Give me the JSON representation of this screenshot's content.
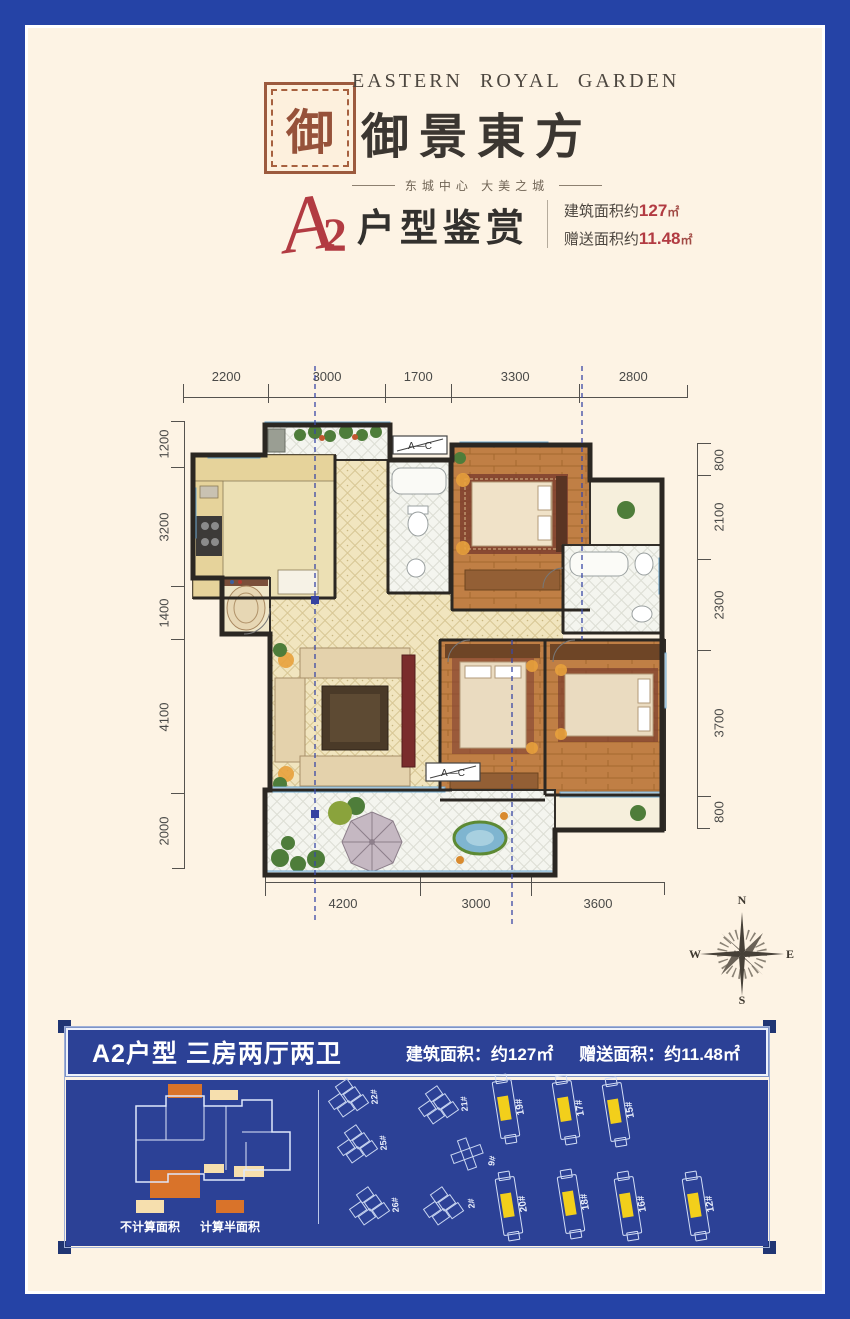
{
  "colors": {
    "frame_blue": "#2543a6",
    "background_cream": "#fdf3e4",
    "accent_red": "#b23b42",
    "panel_blue": "#2c4196",
    "highlight_yellow": "#f2cf1b",
    "seal_brown": "#9c5a3e"
  },
  "header": {
    "brand_en": "EASTERN ROYAL GARDEN",
    "brand_cn": "御景東方",
    "tagline": "东城中心  大美之城",
    "seal_glyph": "御"
  },
  "title": {
    "unit_letter": "A",
    "unit_number": "2",
    "suffix": "户型鉴赏",
    "area_label_1": "建筑面积约",
    "area_value_1": "127",
    "area_unit_1": "㎡",
    "area_label_2": "赠送面积约",
    "area_value_2": "11.48",
    "area_unit_2": "㎡"
  },
  "plan": {
    "dims_top": [
      2200,
      3000,
      1700,
      3300,
      2800
    ],
    "dims_left": [
      1200,
      3200,
      1400,
      4100,
      2000
    ],
    "dims_right": [
      800,
      2100,
      2300,
      3700,
      800
    ],
    "dims_bottom": [
      4200,
      3000,
      3600
    ],
    "ac_label": "A—C",
    "compass": {
      "north": "N",
      "south": "S",
      "east": "E",
      "west": "W"
    }
  },
  "bottom_panel": {
    "title": "A2户型 三房两厅两卫",
    "spec_1_label": "建筑面积：",
    "spec_1_value": "约127㎡",
    "spec_2_label": "赠送面积：",
    "spec_2_value": "约11.48㎡",
    "legend": [
      {
        "label": "不计算面积",
        "color": "#f6dfae"
      },
      {
        "label": "计算半面积",
        "color": "#d9732a"
      }
    ],
    "sitemap": {
      "buildings": [
        {
          "label": "22#",
          "type": "cluster",
          "x": 284,
          "y": 18,
          "rot": -35,
          "highlighted": false
        },
        {
          "label": "25#",
          "type": "cluster",
          "x": 293,
          "y": 64,
          "rot": -35,
          "highlighted": false
        },
        {
          "label": "26#",
          "type": "cluster",
          "x": 305,
          "y": 126,
          "rot": -35,
          "highlighted": false
        },
        {
          "label": "21#",
          "type": "cluster",
          "x": 374,
          "y": 25,
          "rot": -35,
          "highlighted": false
        },
        {
          "label": "9#",
          "type": "cross",
          "x": 401,
          "y": 74,
          "rot": -20,
          "highlighted": false
        },
        {
          "label": "2#",
          "type": "cluster",
          "x": 379,
          "y": 126,
          "rot": -35,
          "highlighted": false
        },
        {
          "label": "19#",
          "type": "slab",
          "x": 440,
          "y": 29,
          "rot": -9,
          "highlighted": true
        },
        {
          "label": "17#",
          "type": "slab",
          "x": 500,
          "y": 30,
          "rot": -9,
          "highlighted": true
        },
        {
          "label": "15#",
          "type": "slab",
          "x": 550,
          "y": 32,
          "rot": -9,
          "highlighted": true
        },
        {
          "label": "20#",
          "type": "slab",
          "x": 443,
          "y": 126,
          "rot": -9,
          "highlighted": true
        },
        {
          "label": "18#",
          "type": "slab",
          "x": 505,
          "y": 124,
          "rot": -9,
          "highlighted": true
        },
        {
          "label": "16#",
          "type": "slab",
          "x": 562,
          "y": 126,
          "rot": -9,
          "highlighted": true
        },
        {
          "label": "12#",
          "type": "slab",
          "x": 630,
          "y": 126,
          "rot": -9,
          "highlighted": true
        }
      ]
    }
  }
}
